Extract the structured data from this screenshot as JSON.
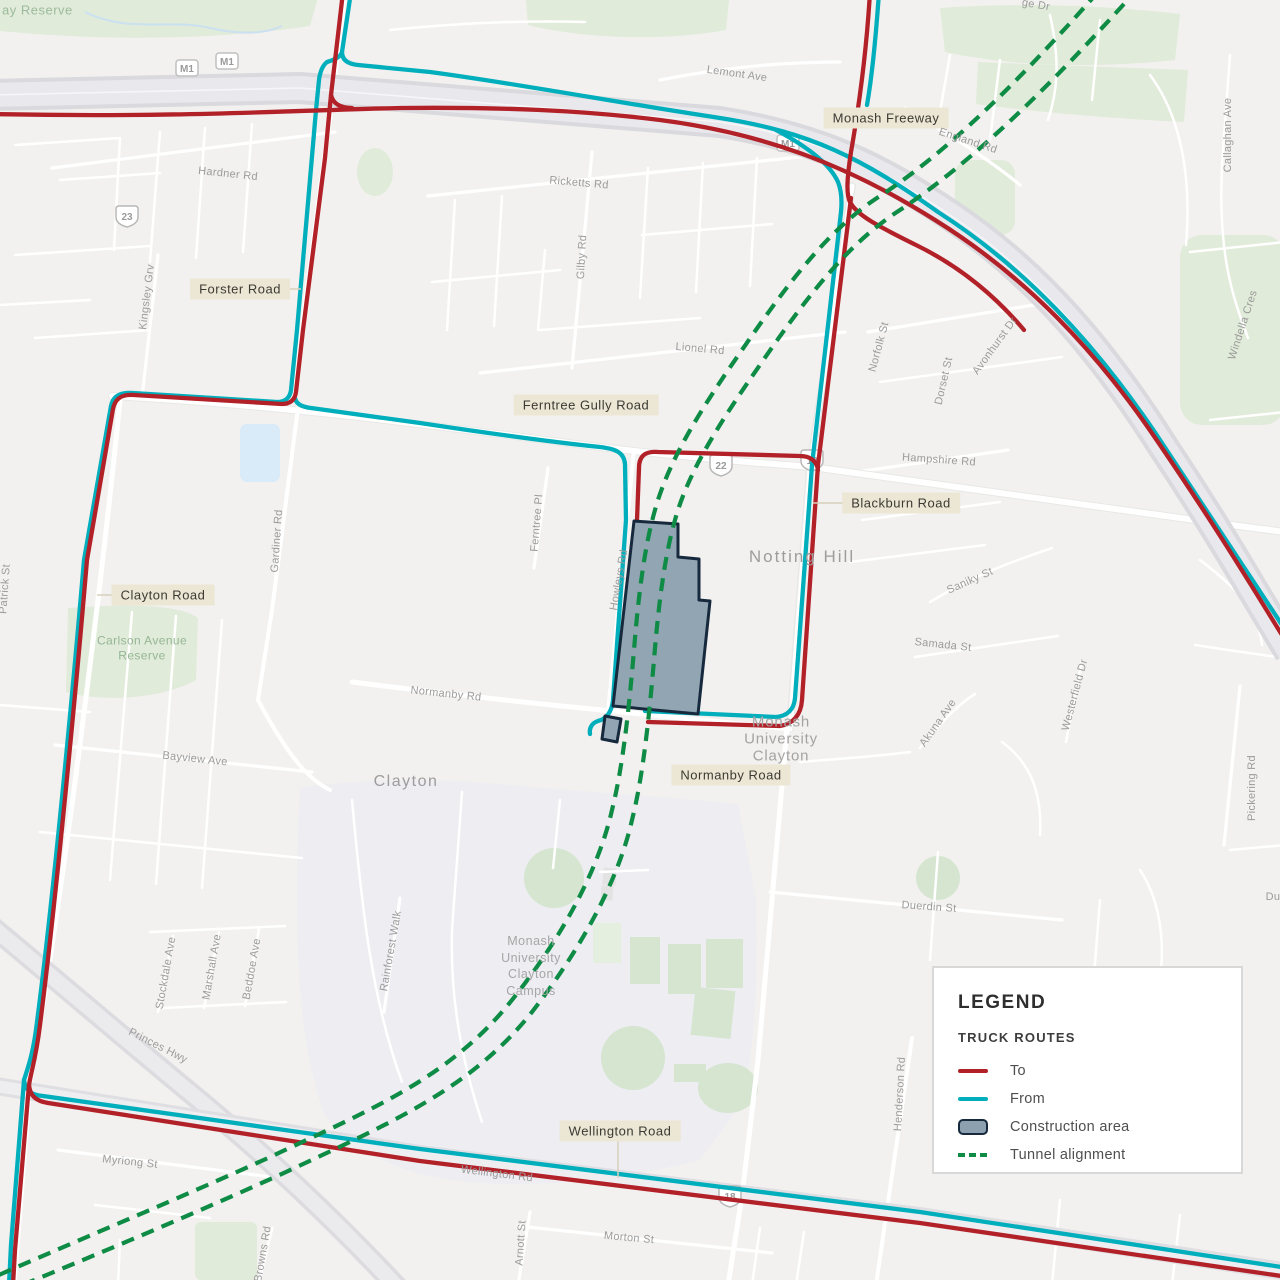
{
  "colors": {
    "route_to": "#B22028",
    "route_from": "#00AEBC",
    "tunnel_alignment": "#0E8B45",
    "construction_fill": "#8CA0AF",
    "construction_stroke": "#17293D",
    "label_background": "#ECE6D4",
    "motorway_fill": "#E9E9ED",
    "map_background": "#F2F1EF"
  },
  "legend": {
    "title": "LEGEND",
    "section_title": "TRUCK ROUTES",
    "items": {
      "to": "To",
      "from": "From",
      "construction": "Construction area",
      "tunnel": "Tunnel alignment"
    }
  },
  "map": {
    "boxed_labels": {
      "monash_freeway": "Monash Freeway",
      "forster_road": "Forster Road",
      "ferntree_gully_road": "Ferntree Gully Road",
      "blackburn_road": "Blackburn Road",
      "clayton_road": "Clayton Road",
      "normanby_road": "Normanby Road",
      "wellington_road": "Wellington Road"
    },
    "suburb_labels": {
      "notting_hill": "Notting Hill",
      "clayton": "Clayton"
    },
    "poi_labels": {
      "monash_university_line1": "Monash",
      "monash_university_line2": "University",
      "monash_university_line3": "Clayton",
      "campus_line1": "Monash",
      "campus_line2": "University",
      "campus_line3": "Clayton",
      "campus_line4": "Campus"
    },
    "area_labels": {
      "reserve_partial": "ay Reserve",
      "carlson_line1": "Carlson Avenue",
      "carlson_line2": "Reserve"
    },
    "street_labels": {
      "lemont_ave": "Lemont Ave",
      "england_rd": "England Rd",
      "callaghan_ave": "Callaghan Ave",
      "windella_cres": "Windella Cres",
      "hardner_rd": "Hardner Rd",
      "kingsley_grv": "Kingsley Grv",
      "ricketts_rd": "Ricketts Rd",
      "gilby_rd": "Gilby Rd",
      "lionel_rd": "Lionel Rd",
      "norfolk_st": "Norfolk St",
      "dorset_st": "Dorset St",
      "avonhurst_dr": "Avonhurst Dr",
      "hampshire_rd": "Hampshire Rd",
      "saniky_st": "Saniky St",
      "samada_st": "Samada St",
      "westerfield_dr": "Westerfield Dr",
      "pickering_rd": "Pickering Rd",
      "akuna_ave": "Akuna Ave",
      "duerdin_st": "Duerdin St",
      "duerdin_partial": "Du",
      "ferntree_pl": "Ferntree Pl",
      "howleys_rd": "Howleys Rd",
      "gardiner_rd": "Gardiner Rd",
      "patrick_st": "Patrick St",
      "bayview_ave": "Bayview Ave",
      "normanby_rd_street": "Normanby Rd",
      "stockdale_ave": "Stockdale Ave",
      "marshall_ave": "Marshall Ave",
      "beddoe_ave": "Beddoe Ave",
      "rainforest_walk": "Rainforest Walk",
      "princes_hwy": "Princes Hwy",
      "myriong_st": "Myriong St",
      "browns_rd": "Browns Rd",
      "wellington_rd_street": "Wellington Rd",
      "morton_st": "Morton St",
      "arnott_st": "Arnott St",
      "henderson_rd": "Henderson Rd",
      "ge_dr_partial": "ge Dr"
    },
    "route_shields": {
      "m1": "M1",
      "r23": "23",
      "r22": "22",
      "r13": "13",
      "r18": "18"
    }
  }
}
